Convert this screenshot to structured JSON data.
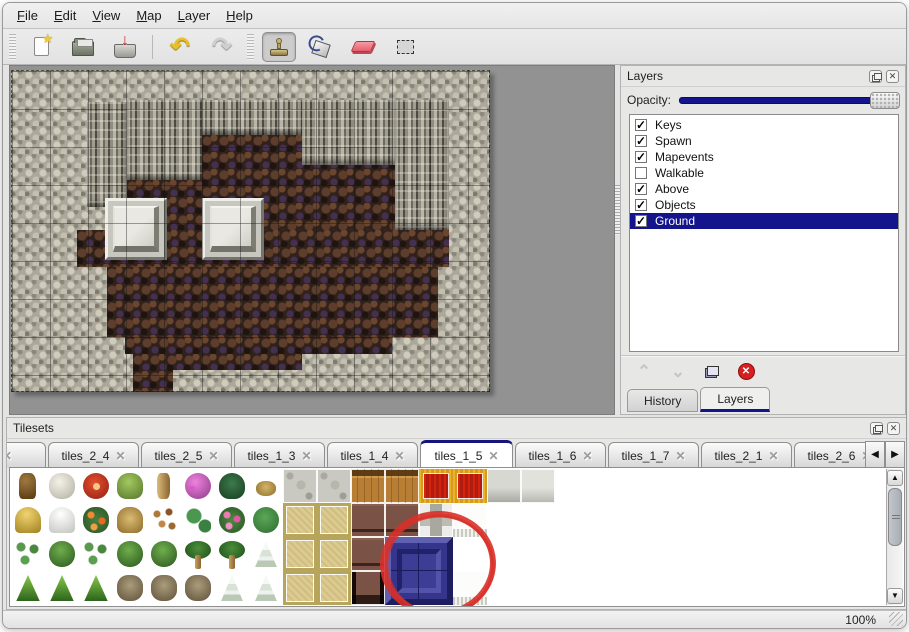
{
  "menu": {
    "items": [
      "File",
      "Edit",
      "View",
      "Map",
      "Layer",
      "Help"
    ]
  },
  "toolbar": {
    "buttons": [
      "new-file",
      "open",
      "save",
      "undo",
      "redo",
      "stamp",
      "fill",
      "eraser",
      "select"
    ],
    "selected_tool": "stamp"
  },
  "icons": {
    "star": "★",
    "save_arrow": "↓",
    "undo": "↶",
    "redo": "↷",
    "close": "✕",
    "check": "✓",
    "chevron_up": "⌃",
    "chevron_down": "⌄",
    "arrow_up": "▲",
    "arrow_down": "▼",
    "arrow_left": "◀",
    "arrow_right": "▶",
    "delete_x": "✕"
  },
  "layers_panel": {
    "title": "Layers",
    "opacity_label": "Opacity:",
    "opacity_value_percent": 100,
    "layers": [
      {
        "name": "Keys",
        "checked": true,
        "selected": false
      },
      {
        "name": "Spawn",
        "checked": true,
        "selected": false
      },
      {
        "name": "Mapevents",
        "checked": true,
        "selected": false
      },
      {
        "name": "Walkable",
        "checked": false,
        "selected": false
      },
      {
        "name": "Above",
        "checked": true,
        "selected": false
      },
      {
        "name": "Objects",
        "checked": true,
        "selected": false
      },
      {
        "name": "Ground",
        "checked": true,
        "selected": true
      }
    ],
    "action_buttons": [
      "move-layer-up",
      "move-layer-down",
      "duplicate-layer",
      "delete-layer"
    ],
    "tabs": [
      "History",
      "Layers"
    ],
    "active_tab": "Layers"
  },
  "tilesets_panel": {
    "title": "Tilesets",
    "tabs": [
      {
        "label": "3",
        "clipped": true
      },
      {
        "label": "tiles_2_4",
        "clipped": false
      },
      {
        "label": "tiles_2_5",
        "clipped": false
      },
      {
        "label": "tiles_1_3",
        "clipped": false
      },
      {
        "label": "tiles_1_4",
        "clipped": false
      },
      {
        "label": "tiles_1_5",
        "clipped": false
      },
      {
        "label": "tiles_1_6",
        "clipped": false
      },
      {
        "label": "tiles_1_7",
        "clipped": false
      },
      {
        "label": "tiles_2_1",
        "clipped": false
      },
      {
        "label": "tiles_2_6",
        "clipped": false
      }
    ],
    "active_tab": "tiles_1_5",
    "tile_grid": {
      "cell_size": 34,
      "rows": [
        [
          "trunk",
          "deadtree",
          "flower-red",
          "stump",
          "trunk-tall",
          "bush-pink",
          "fern",
          "plant-small",
          "stone",
          "stone2",
          "wood",
          "wood",
          "carpet",
          "carpet",
          "slab",
          "slab2"
        ],
        [
          "hay",
          "snow-mound",
          "flowers-orange",
          "grass-dry",
          "leaves",
          "lilypad",
          "roses",
          "lilypad2",
          "khaki",
          "khaki",
          "table",
          "table",
          "pillar",
          "white-fringe",
          "blank",
          "blank"
        ],
        [
          "sprouts",
          "bush",
          "sprouts",
          "bush",
          "bush",
          "palm",
          "palm",
          "pine-snow",
          "khaki",
          "khaki",
          "table",
          "blank",
          "blank",
          "blank",
          "blank",
          "blank"
        ],
        [
          "cone-tree",
          "cone-tree",
          "cone-tree",
          "bare-tree",
          "bare-tree",
          "bare-tree",
          "pine-snow",
          "pine-snow",
          "khaki",
          "khaki",
          "table2",
          "blank",
          "blank",
          "white-fringe",
          "blank",
          "blank"
        ]
      ],
      "selected_tile": {
        "x": 375,
        "y": 69,
        "size": 68
      },
      "annotation_circle": {
        "cx": 428,
        "cy": 96,
        "rx": 55,
        "ry": 50
      }
    }
  },
  "map_document": {
    "tile_size": 38,
    "width": 479,
    "height": 322,
    "base": "rock",
    "regions": [
      {
        "type": "floor",
        "x": 191,
        "y": 65,
        "w": 193,
        "h": 95
      },
      {
        "type": "floor",
        "x": 116,
        "y": 110,
        "w": 75,
        "h": 50
      },
      {
        "type": "floor",
        "x": 66,
        "y": 160,
        "w": 372,
        "h": 37
      },
      {
        "type": "floor",
        "x": 96,
        "y": 197,
        "w": 331,
        "h": 70
      },
      {
        "type": "floor",
        "x": 114,
        "y": 267,
        "w": 267,
        "h": 17
      },
      {
        "type": "floor",
        "x": 122,
        "y": 284,
        "w": 169,
        "h": 16
      },
      {
        "type": "floor",
        "x": 122,
        "y": 284,
        "w": 40,
        "h": 38
      },
      {
        "type": "cliff",
        "x": 76,
        "y": 32,
        "w": 40,
        "h": 105
      },
      {
        "type": "cliff",
        "x": 116,
        "y": 30,
        "w": 75,
        "h": 80
      },
      {
        "type": "cliff",
        "x": 191,
        "y": 30,
        "w": 100,
        "h": 35
      },
      {
        "type": "cliff",
        "x": 291,
        "y": 30,
        "w": 93,
        "h": 65
      },
      {
        "type": "cliff",
        "x": 384,
        "y": 30,
        "w": 54,
        "h": 130
      }
    ],
    "platforms": [
      {
        "x": 94,
        "y": 128,
        "w": 62,
        "h": 62
      },
      {
        "x": 191,
        "y": 128,
        "w": 62,
        "h": 62
      }
    ]
  },
  "status_bar": {
    "zoom": "100%"
  },
  "colors": {
    "accent_navy": "#14148c",
    "annotation_red": "#d83028",
    "selection_bg": "#14148c",
    "floor_brown": "#31211b",
    "rock_gray": "#aba89b"
  }
}
